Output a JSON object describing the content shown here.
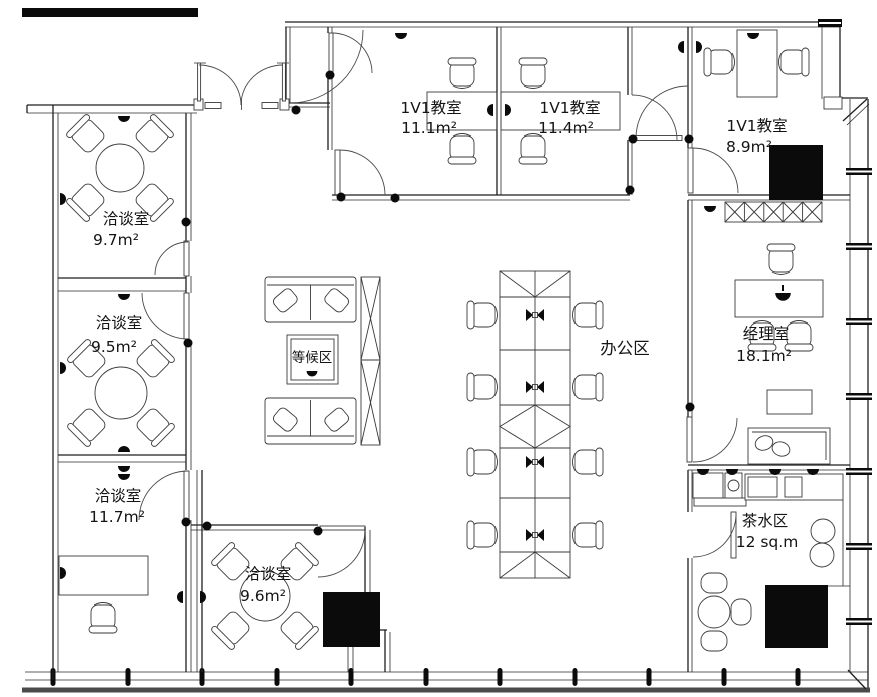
{
  "plan": {
    "title": "office floor plan",
    "colors": {
      "ink": "#1f1f1f",
      "solid_fill": "#0b0b0b",
      "background": "#ffffff"
    },
    "symbols": {
      "wall_light": "half-dome",
      "workstation_monitor": "bowtie",
      "door_hinge": "dot",
      "column": "solid-square",
      "shelf": "x-hatch"
    },
    "rooms": {
      "m1": {
        "name": "洽谈室",
        "area": "9.7m²"
      },
      "m2": {
        "name": "洽谈室",
        "area": "9.5m²"
      },
      "m3": {
        "name": "洽谈室",
        "area": "11.7m²"
      },
      "m4": {
        "name": "洽谈室",
        "area": "9.6m²"
      },
      "c1": {
        "name": "1V1教室",
        "area": "11.1m²"
      },
      "c2": {
        "name": "1V1教室",
        "area": "11.4m²"
      },
      "c3": {
        "name": "1V1教室",
        "area": "8.9m²"
      },
      "waiting": {
        "name": "等候区"
      },
      "office": {
        "name": "办公区"
      },
      "manager": {
        "name": "经理室",
        "area": "18.1m²"
      },
      "tea": {
        "name": "茶水区",
        "area": "12 sq.m"
      }
    }
  }
}
